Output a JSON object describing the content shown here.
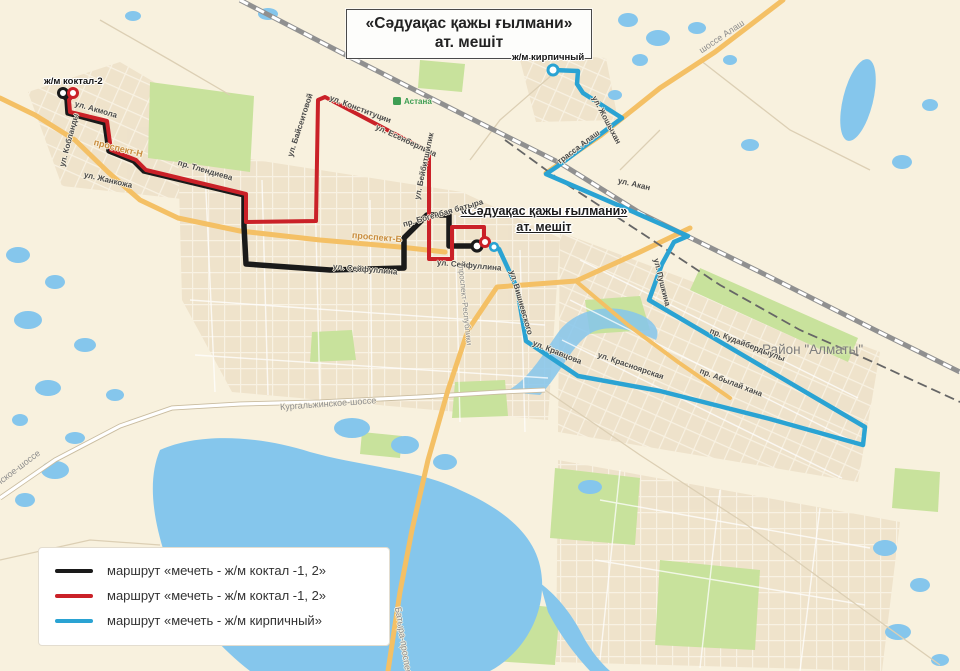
{
  "title": {
    "line1": "«Сәдуақас қажы ғылмани»",
    "line2": "ат. мешіт"
  },
  "mosque_label": {
    "line1": "«Сәдуақас қажы ғылмани»",
    "line2": "ат. мешіт"
  },
  "places": {
    "koktal": "ж/м коктал-2",
    "kirpichny": "ж/м кирпичный",
    "rayon_almaty": "Район \"Алматы\"",
    "astana_station": "Астана"
  },
  "streets": {
    "akmola": "ул. Акмола",
    "koblandy": "ул. Кобланды",
    "zhankozha": "ул. Жанкожа",
    "prospekt_n": "проспект-Н",
    "tlendieva": "пр. Тлендиева",
    "baiseitovoy": "ул. Байсеитовой",
    "konstitutsii": "ул. Конституции",
    "esenberlina": "ул. Есенберлина",
    "beibitshilik": "ул. Бейбитшилик",
    "bogenbay": "пр. Богенбая батыра",
    "prospekt_b": "проспект-Б",
    "seifullina": "ул. Сейфуллина",
    "respubliki": "проспект-Республики",
    "vishnevskogo": "ул. Вишневского",
    "kravtsova": "ул. Кравцова",
    "krasnoyarskaya": "ул. Красноярская",
    "pushkina": "ул. Пушкина",
    "kudaiberdyuly": "пр. Кудайбердыулы",
    "abylay_khana": "пр. Абылай хана",
    "trassa_alash": "трасса Алаш",
    "shosse_alash": "шоссе Алаш",
    "zhoshykhan": "ул. Жошыхан",
    "akan": "ул. Акан",
    "kurgalzhinskoe": "Кургальжинское-шоссе",
    "batyra_prospekt": "Батыра-проспект"
  },
  "legend": {
    "items": [
      {
        "label": "маршрут «мечеть - ж/м коктал -1, 2»",
        "color": "#1a1a1a"
      },
      {
        "label": "маршрут «мечеть - ж/м коктал -1, 2»",
        "color": "#ca2128"
      },
      {
        "label": "маршрут «мечеть - ж/м кирпичный»",
        "color": "#2aa3d3"
      }
    ]
  },
  "routes": {
    "black": {
      "name": "мечеть - ж/м коктал (подача)",
      "color": "#1a1a1a",
      "points": "63,95 67,99 68,113 105,123 109,151 134,161 144,171 244,195 244,226 246,264 330,270 404,268 404,238 427,215 449,215 449,246 475,246"
    },
    "red": {
      "name": "мечеть - ж/м коктал",
      "color": "#ca2128",
      "points": "73,95 69,100 70,112 107,121 111,150 136,160 146,170 246,194 246,222 316,221 318,100 325,97 429,152 429,259 452,259 452,227 484,227 484,242"
    },
    "blue": {
      "name": "мечеть - ж/м кирпичный",
      "color": "#2aa3d3",
      "points": "553,70 578,71 577,84 583,93 622,118 558,166 546,174 620,206 688,236 674,242 662,264 649,300 865,427 863,445 770,419 660,391 578,376 526,341 517,288 499,249 495,246"
    }
  },
  "map_colors": {
    "background": "#f8f1de",
    "water": "#85c6ec",
    "green": "#c8e29c",
    "blocks": "#eee1c9",
    "main_road": "#f4c065",
    "railway": "#909090"
  }
}
